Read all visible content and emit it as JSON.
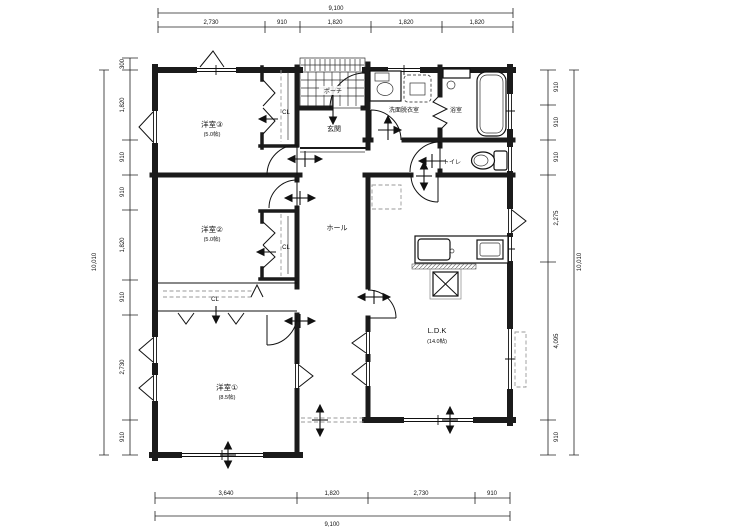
{
  "plan": {
    "rooms": {
      "yoshitsu3": {
        "name": "洋室③",
        "size": "(5.0帖)"
      },
      "yoshitsu2": {
        "name": "洋室②",
        "size": "(5.0帖)"
      },
      "yoshitsu1": {
        "name": "洋室①",
        "size": "(8.5帖)"
      },
      "ldk": {
        "name": "L.D.K",
        "size": "(14.0帖)"
      },
      "genkan": {
        "name": "玄関"
      },
      "hall": {
        "name": "ホール"
      },
      "porch": {
        "name": "ポーチ"
      },
      "washroom": {
        "name": "洗面脱衣室"
      },
      "bathroom": {
        "name": "浴室"
      },
      "toilet": {
        "name": "トイレ"
      },
      "closet_a": {
        "name": "CL"
      },
      "closet_b": {
        "name": "CL"
      },
      "closet_c": {
        "name": "CL"
      }
    },
    "dimensions": {
      "top": {
        "total": "9,100",
        "segments": [
          "2,730",
          "910",
          "1,820",
          "1,820",
          "1,820"
        ]
      },
      "bottom": {
        "total": "9,100",
        "segments": [
          "3,640",
          "1,820",
          "2,730",
          "910"
        ]
      },
      "left": {
        "total": "10,010",
        "segments": [
          "300",
          "1,820",
          "910",
          "910",
          "1,820",
          "910",
          "2,730",
          "910"
        ]
      },
      "right": {
        "total": "10,010",
        "segments": [
          "910",
          "910",
          "910",
          "2,275",
          "4,095",
          "910"
        ]
      }
    },
    "colors": {
      "wall": "#1b1b1b",
      "line": "#111111",
      "dim": "#222222",
      "dashed": "#9a9a9a"
    }
  }
}
